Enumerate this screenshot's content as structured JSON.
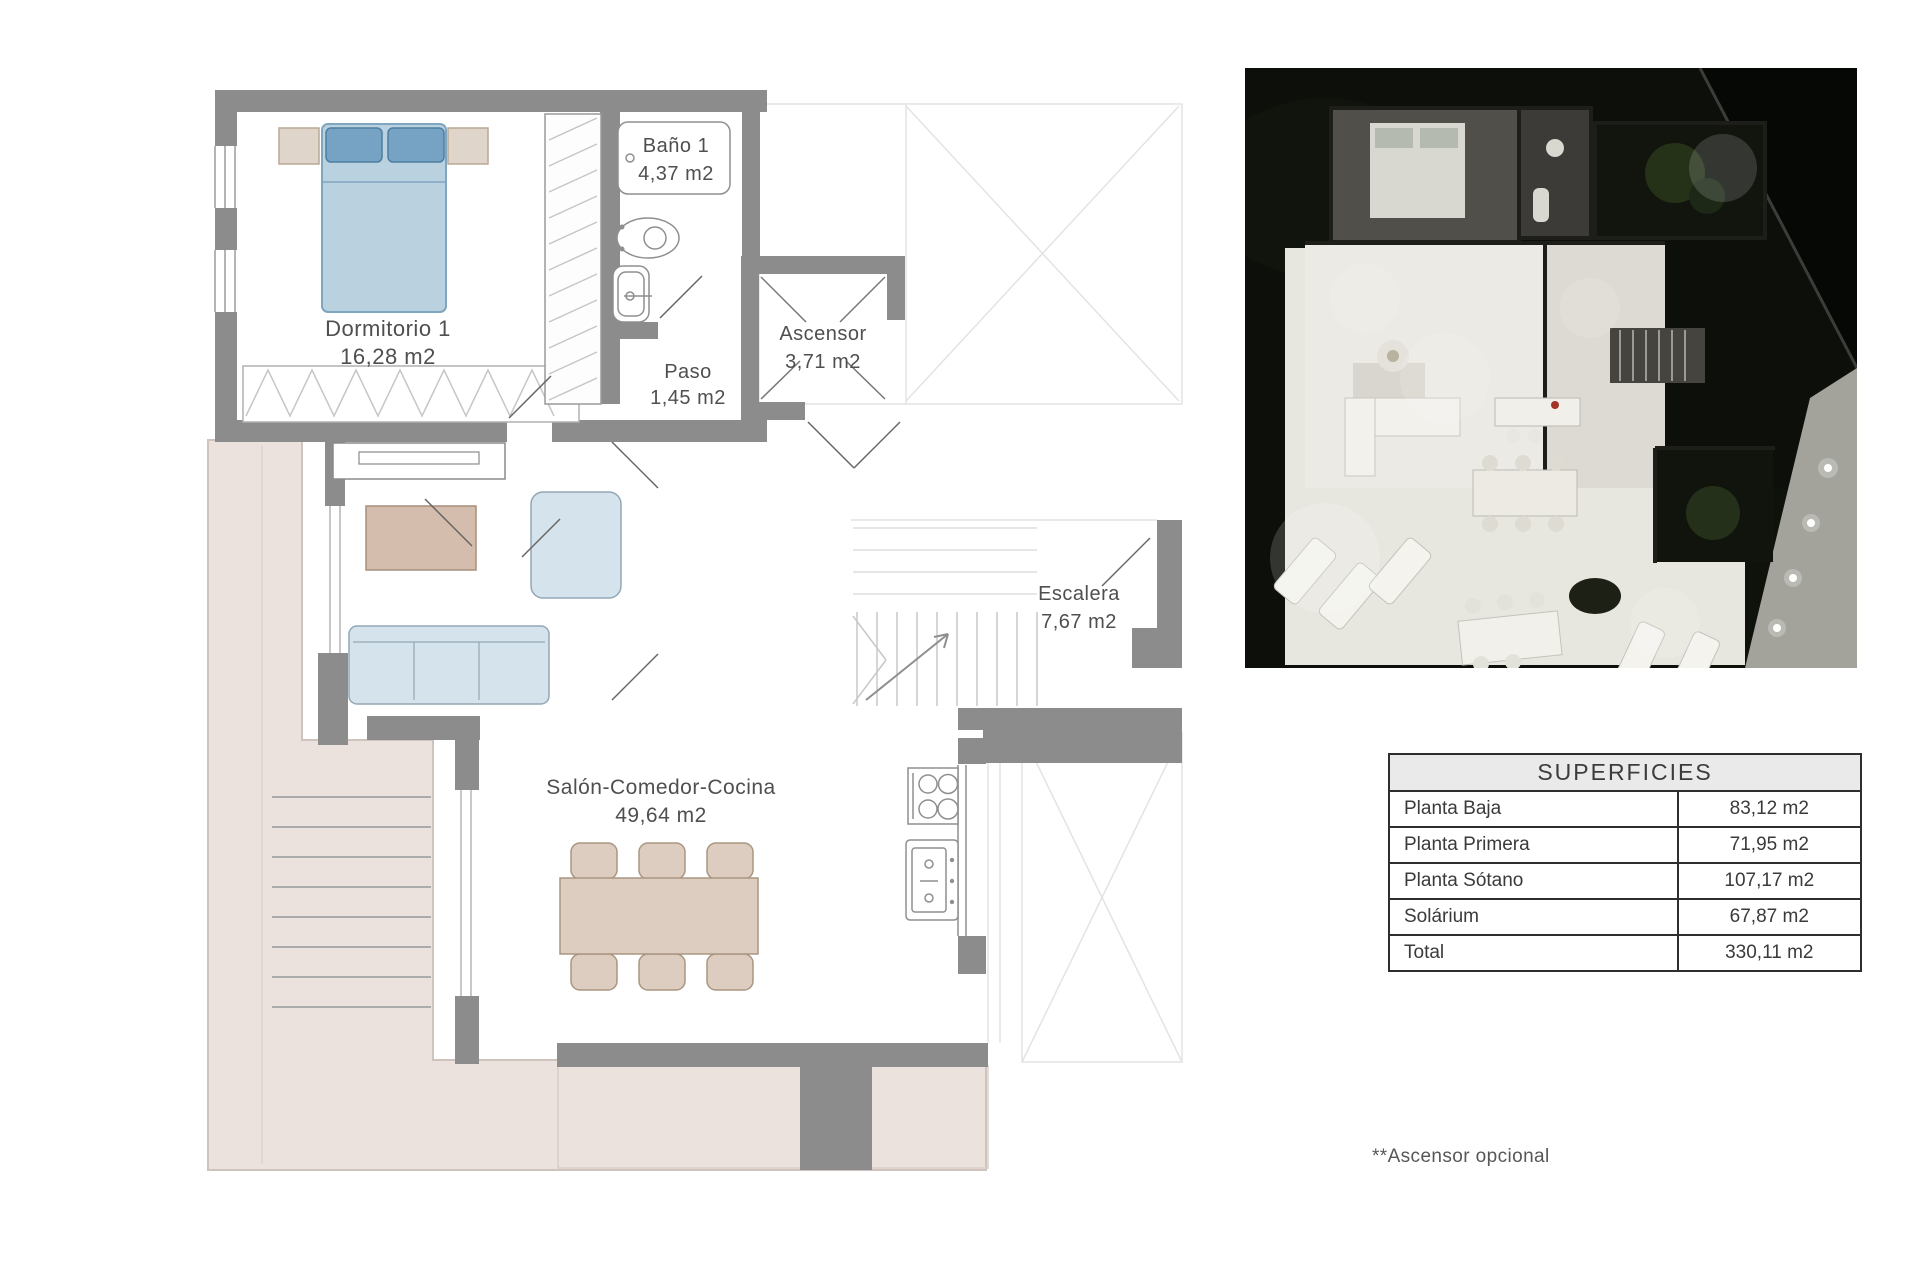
{
  "plan": {
    "rooms": [
      {
        "name": "Dormitorio 1",
        "area": "16,28 m2"
      },
      {
        "name": "Baño 1",
        "area": "4,37 m2"
      },
      {
        "name": "Ascensor",
        "area": "3,71 m2"
      },
      {
        "name": "Paso",
        "area": "1,45 m2"
      },
      {
        "name": "Escalera",
        "area": "7,67 m2"
      },
      {
        "name": "Salón-Comedor-Cocina",
        "area": "49,64 m2"
      }
    ],
    "colors": {
      "wall": "#8c8c8c",
      "terrace": "#ece2dd",
      "bed": "#bad1e0",
      "pillow": "#76a3c4",
      "nightstand": "#e0d5cb",
      "sofa": "#d5e3ec",
      "coffee_table": "#d4bdac",
      "dining": "#dccdc0"
    }
  },
  "superficies_table": {
    "title": "SUPERFICIES",
    "rows": [
      {
        "label": "Planta Baja",
        "value": "83,12 m2"
      },
      {
        "label": "Planta Primera",
        "value": "71,95 m2"
      },
      {
        "label": "Planta Sótano",
        "value": "107,17 m2"
      },
      {
        "label": "Solárium",
        "value": "67,87 m2"
      },
      {
        "label": "Total",
        "value": "330,11 m2"
      }
    ]
  },
  "footnote": "**Ascensor opcional"
}
